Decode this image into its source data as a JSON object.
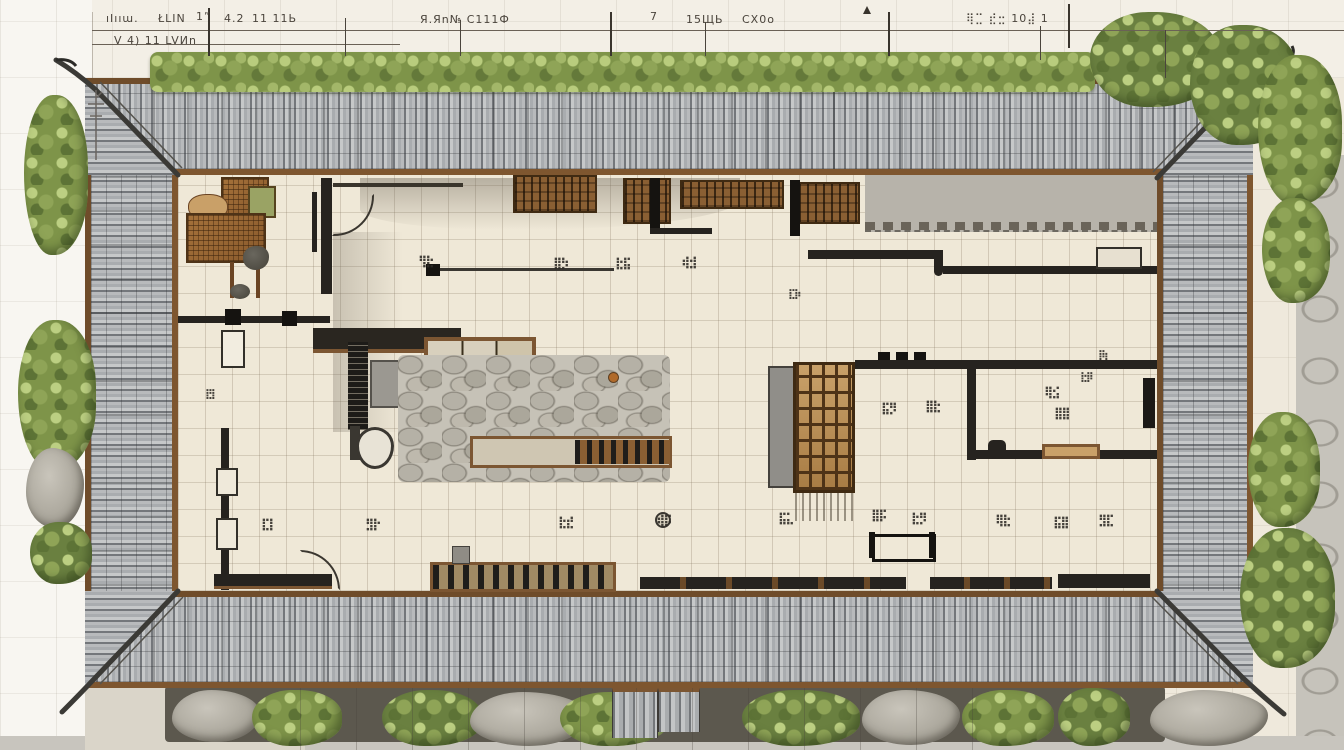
{
  "palette": {
    "paper": "#EFE9DC",
    "roof_tile": "#9FA2A4",
    "eave_brown": "#7C5632",
    "wall_dark": "#26231F",
    "floor_cream": "#EFE8D7",
    "foliage_green": "#8FA352",
    "stone_grey": "#B3AFA6",
    "courtyard_cobble": "#C6C2B7",
    "lattice_pane": "#C9A169"
  },
  "dimension_strip": {
    "row1": [
      "ıIııա.",
      "ŁLIN",
      "1”",
      "4.2",
      "11 11Ь",
      "Я.Яո№ С111Ф",
      "7",
      "15ЩЬ",
      "СХ0о",
      "⢿⣉ ⣞⣒ 10⣼ 1"
    ],
    "row2": [
      "V 4) 11 LVИո"
    ]
  },
  "plan": {
    "room_labels": [
      "⢻⣗",
      "⣿⡳",
      "⣗⣯",
      "⢾⣺",
      "⣏⡷",
      "⣟⡇",
      "⣯⡻",
      "⣿⣗",
      "⡿⡆",
      "⣗⡿",
      "⢿⣪",
      "⣿⣿",
      "⣏⡇",
      "⣻⡗",
      "⣗⣞",
      "⢾⡯",
      "⣯⣅",
      "⣿⡯",
      "⣗⡻",
      "⢿⣗",
      "⣯⣿",
      "⣻⣏"
    ]
  }
}
